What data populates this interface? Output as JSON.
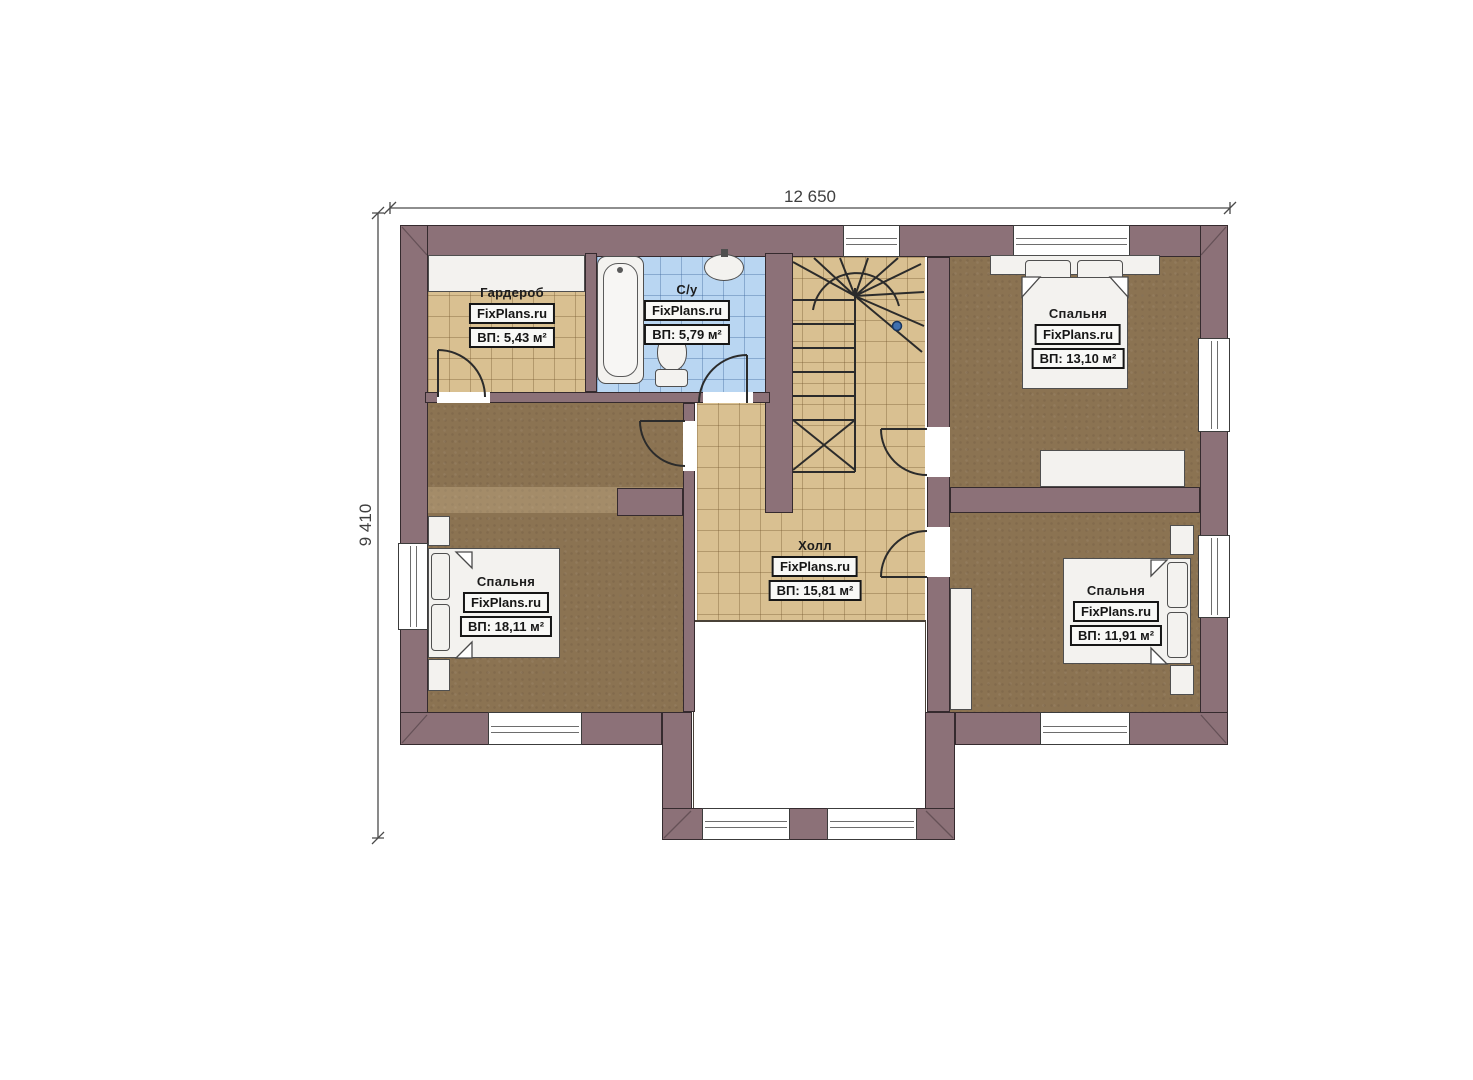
{
  "watermark": "FixPlans.ru",
  "dimensions": {
    "width": "12 650",
    "height": "9 410"
  },
  "rooms": [
    {
      "name": "Гардероб",
      "area": "ВП: 5,43 м²"
    },
    {
      "name": "С/у",
      "area": "ВП: 5,79 м²"
    },
    {
      "name": "Спальня",
      "area": "ВП: 13,10 м²"
    },
    {
      "name": "Спальня",
      "area": "ВП: 18,11 м²"
    },
    {
      "name": "Холл",
      "area": "ВП: 15,81 м²"
    },
    {
      "name": "Спальня",
      "area": "ВП: 11,91 м²"
    }
  ],
  "colors": {
    "wall": "#8c7178",
    "wall_line": "#352a2e",
    "wood_floor": "#8b7352",
    "tile_tan": "#d9c091",
    "tile_blue": "#b9d6f2",
    "fixture_white": "#f3f2ef",
    "stair_marker_blue": "#3f6fae"
  }
}
